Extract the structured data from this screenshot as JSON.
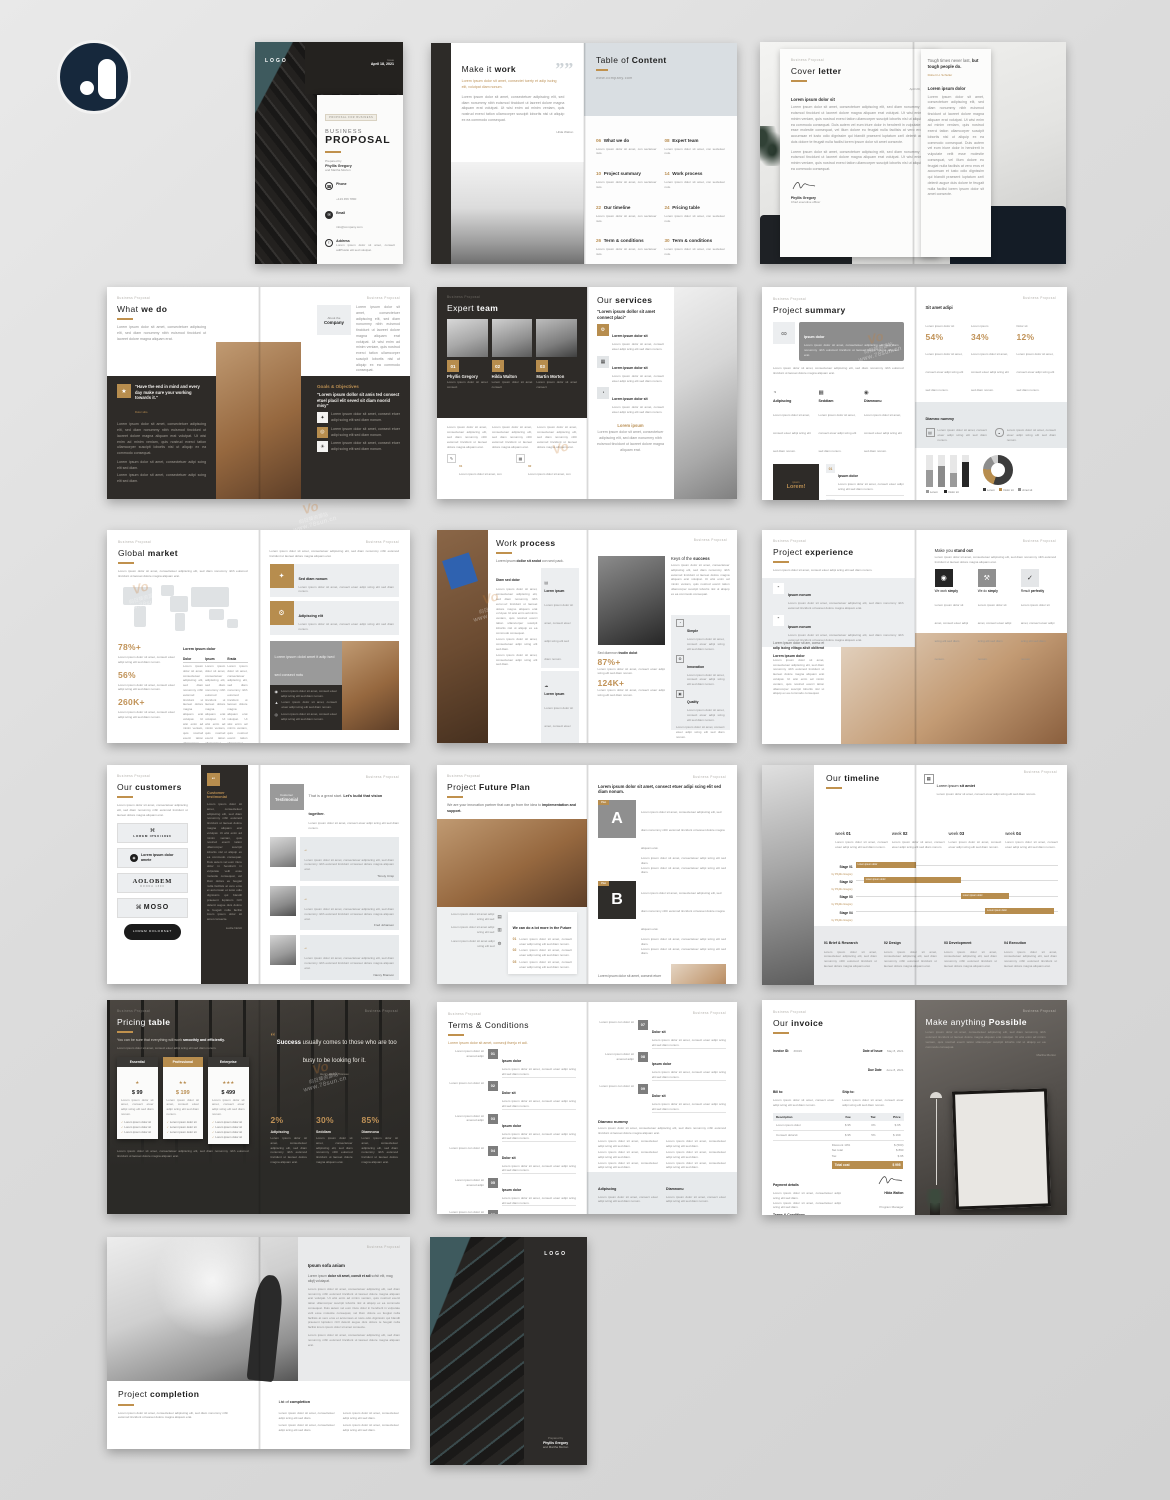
{
  "watermark": {
    "cn": "向日葵资源站",
    "url": "www.78sun.cn",
    "v": "Vo"
  },
  "page_header": "Business Proposal",
  "lorem": {
    "xs": "Lorem ipsum dolor sit amet, consect etuer adipi scing elit sed diam nonum.",
    "s": "Lorem ipsum dolor sit amet, consectetuer adipiscing elit, sed diam nonummy nibh euismod tincidunt ut laoreet dolore magna aliquam erat.",
    "m": "Lorem ipsum dolor sit amet, consectetuer adipiscing elit, sed diam nonummy nibh euismod tincidunt ut laoreet dolore magna aliquam erat volutpat. Ut wisi enim ad minim veniam, quis nostrud exerci tation ullamcorper suscipit lobortis nisl ut aliquip ex ea commodo consequat.",
    "l": "Lorem ipsum dolor sit amet, consectetuer adipiscing elit, sed diam nonummy nibh euismod tincidunt ut laoreet dolore magna aliquam erat volutpat. Ut wisi enim ad minim veniam, quis nostrud exerci tation ullamcorper suscipit lobortis nisl ut aliquip ex ea commodo consequat. Duis autem vel eum iriure dolor in hendrerit in vulputate velit esse molestie consequat, vel illum dolore eu feugiat nulla facilisis at vero eros et accumsan et iusto odio dignissim qui blandit praesent luptatum zzril delenit augue duis dolore te feugait nulla facilisi lorem ipsum dolor sit amet consecte.",
    "bullet": "Lorem ipsum dolor sit amet, consectetuer adipi scing elit sed diam."
  },
  "cover": {
    "logo": "LOGO",
    "issue_label": "Issue",
    "issue_date": "April 18, 2021",
    "tag": "PROPOSAL FOR BUSINESS",
    "title_thin": "BUSINESS",
    "title_bold": "PROPOSAL",
    "prepared_label": "Prepared by",
    "prepared_name": "Phyllis Gregory",
    "prepared_name2": "and Martha Morton",
    "contacts": [
      {
        "glyph": "☎",
        "label": "Phone",
        "value": "+123 456 7890"
      },
      {
        "glyph": "✉",
        "label": "Email",
        "value": "info@company.com"
      },
      {
        "glyph": "⚐",
        "label": "Address",
        "value": "Lorem ipsum dolor sit amet, consect adiPlustio elit sed volutpat."
      }
    ]
  },
  "intro": {
    "title_thin": "Make it ",
    "title_bold": "work",
    "quote_glyph": "””",
    "lead": "Lorem ipsum dolor sit amet, consectet tuerty et adip iscing elit, volutpat diam nonum.",
    "author": "Hilda Walton"
  },
  "toc": {
    "title_thin": "Table of ",
    "title_bold": "Content",
    "site": "www.company.com",
    "item_desc": "Lorem ipsum dolor sit amet, con sectetuer nuis.",
    "items": [
      {
        "num": "06",
        "label": "What we do"
      },
      {
        "num": "08",
        "label": "Expert team"
      },
      {
        "num": "10",
        "label": "Project summary"
      },
      {
        "num": "14",
        "label": "Work process"
      },
      {
        "num": "22",
        "label": "Our timeline"
      },
      {
        "num": "24",
        "label": "Pricing table"
      },
      {
        "num": "26",
        "label": "Term & conditions"
      },
      {
        "num": "30",
        "label": "Term & conditions"
      }
    ]
  },
  "letter": {
    "title_thin": "Cover ",
    "title_bold": "letter",
    "date": "April 20, 2021",
    "salutation": "Lorem ipsum dolor sit",
    "sign_name": "Phyllis Gregory",
    "sign_role": "Chief executive officer",
    "quote_thin": "Tough times never last, ",
    "quote_bold": "but tough people do.",
    "quote_author": "Robert H. Schuller",
    "sub": "Lorem ipsum dolor"
  },
  "what_we_do": {
    "title_thin": "What ",
    "title_bold": "we do",
    "about_thin": "About the",
    "about_bold": "Company",
    "quote": "\"Have the end in mind and every day make sure your working towards it.\"",
    "quote_author": "Dolor sitio",
    "goals_title": "Goals & Objectives",
    "goals_lead": "\"Lorem ipsum dollor sit amis ted consect etuel placil elit seved sit diam noorid misy\"",
    "goal_glyphs": [
      "✦",
      "◎",
      "☀"
    ],
    "quote_glyph": "★"
  },
  "team": {
    "title_thin": "Expert ",
    "title_bold": "team",
    "members": [
      {
        "num": "01",
        "name": "Phyllis Gregory"
      },
      {
        "num": "02",
        "name": "Hilda Walton"
      },
      {
        "num": "03",
        "name": "Martin Morton"
      }
    ],
    "member_role": "Lorem ipsum dolor sit amet consect",
    "foot": [
      {
        "num": "01",
        "glyph": "✎"
      },
      {
        "num": "02",
        "glyph": "▦"
      }
    ],
    "foot_text": "Lorem ipsum dolor sit amet, con"
  },
  "services": {
    "title_thin": "Our ",
    "title_bold": "services",
    "lead": "\"Lorem ipsum dollor sit amet connect placi\"",
    "item_title": "Lorem ipsum dolor sit",
    "glyphs": [
      "⚙",
      "▦",
      "◔"
    ],
    "footer_title": "Lorem ipsum"
  },
  "summary": {
    "title_thin": "Project ",
    "title_bold": "summary",
    "bar_glyph": "∞",
    "bar_title": "Ipsum dolor",
    "cols": [
      {
        "glyph": "◔",
        "t": "Adipiscing"
      },
      {
        "glyph": "▦",
        "t": "Seddiam"
      },
      {
        "glyph": "◉",
        "t": "Diamnonu"
      }
    ],
    "dark_tag": "ipsum",
    "dark_word": "Lorem!",
    "nums": [
      {
        "num": "01",
        "t": "Ipsum dolor"
      },
      {
        "num": "02",
        "t": "Dolor sit"
      }
    ],
    "right_head": "Sit amet adipi",
    "stats": [
      {
        "label": "Lorem ipsum dolor sit",
        "value": "54%"
      },
      {
        "label": "Lorem ipsum",
        "value": "34%"
      },
      {
        "label": "Dolor sit",
        "value": "12%"
      }
    ],
    "band_title": "Diamno nummy",
    "band_glyphs": [
      "▤",
      "◒"
    ],
    "chart_bars": [
      "52%",
      "64%",
      "44%",
      "78%"
    ],
    "bar_legend": [
      "Lorem",
      "Dolor sit"
    ],
    "donut_legend": [
      "Lorem",
      "Dolor sit",
      "Amet sit"
    ],
    "donut_values": [
      55,
      21,
      16,
      8
    ],
    "bottom_heads": [
      "Diam sed dolor",
      "Lorem ipsum dolor"
    ]
  },
  "market": {
    "title_thin": "Global ",
    "title_bold": "market",
    "stats": [
      {
        "value": "78%+"
      },
      {
        "value": "56%"
      },
      {
        "value": "260K+"
      }
    ],
    "table_title": "Lorem ipsum dolor",
    "table_cols": [
      "Dolor",
      "Ipsum",
      "Erada"
    ],
    "cell": "Lorem ipsu adipcing elit sed",
    "cards": [
      {
        "glyph": "✦",
        "t": "Sed diam nonum"
      },
      {
        "glyph": "⚙",
        "t": "Adipiscing elit"
      }
    ],
    "panel_title": "Lorem ipsum dolot amet it adip ised sed consect notu",
    "panel_glyphs": [
      "◉",
      "▲",
      "◎"
    ]
  },
  "process": {
    "title_thin": "Work ",
    "title_bold": "process",
    "lead_thin": "Lorem ipsum ",
    "lead_bold": "dollor sit andot",
    "lead_rest": " con sect pack.",
    "sub": "Diam sed dolor",
    "cards": [
      {
        "glyph": "▤"
      },
      {
        "glyph": "☁"
      },
      {
        "glyph": "✎"
      }
    ],
    "card_title": "Lorem ipsum",
    "right_thin": "Keys of the ",
    "right_bold": "success",
    "stat_lead_thin": "Sed diamnon ",
    "stat_lead_bold": "trudin dolot",
    "stats": [
      {
        "value": "87%+"
      },
      {
        "value": "124K+"
      }
    ],
    "keys": [
      {
        "glyph": "◔",
        "t": "Simple"
      },
      {
        "glyph": "⚙",
        "t": "Innovation"
      },
      {
        "glyph": "▣",
        "t": "Quality"
      }
    ]
  },
  "experience": {
    "title_thin": "Project ",
    "title_bold": "experience",
    "items": [
      {
        "glyph": "“",
        "t": "Ipsum nonum"
      },
      {
        "glyph": "“",
        "t": "Ipsum nonum"
      }
    ],
    "bottom_lead_thin": "Lorem ipsum dolor sit am, consc et ",
    "bottom_lead_bold": "adip iscing elitago alisit obliterat",
    "bottom_head": "Lorem ipsum dolor",
    "right_thin": "Make you ",
    "right_bold": "stand out",
    "boxes": [
      {
        "glyph": "◉",
        "label_thin": "We work ",
        "label_bold": "simply"
      },
      {
        "glyph": "⚒",
        "label_thin": "We do ",
        "label_bold": "simply"
      },
      {
        "glyph": "✓",
        "label_thin": "Result ",
        "label_bold": "perfectly"
      }
    ]
  },
  "customers": {
    "title_thin": "Our ",
    "title_bold": "customers",
    "logos": [
      {
        "glyph": "⌘",
        "text": "LOREM IPSU/1890"
      },
      {
        "glyph": "◉",
        "text": "Lorem ipsum dolor amete"
      },
      {
        "text": "AOLOBEM",
        "sub": "DONNA 1890"
      },
      {
        "glyph": "⌘",
        "text": "MOSO"
      },
      {
        "text": "LOREM DOLORSET"
      }
    ],
    "panel_glyph": "“",
    "panel_title": "Customer testimonial",
    "panel_author": "Lucile Nolcit",
    "tag_thin": "Customer",
    "tag_bold": "Testimonial",
    "head_thin": "That is a great start. ",
    "head_bold": "Let's build that vision together.",
    "quote_glyph": "“",
    "testimonials": [
      {
        "name": "Timoty Crisp"
      },
      {
        "name": "Fred Johansen"
      },
      {
        "name": "Nancy Branson"
      }
    ]
  },
  "future": {
    "title_thin": "Project ",
    "title_bold": "Future Plan",
    "lead_thin": "We are your innovation partner that can go from the idea to ",
    "lead_bold": "implementation and support.",
    "side_glyphs": [
      "▤",
      "▥",
      "⚙"
    ],
    "side_text": "Lorem ipsum dolor sit amet adipi scing elit sed",
    "card_head": "We can do a lot more in the Future",
    "card_items": [
      {
        "num": "01"
      },
      {
        "num": "02"
      },
      {
        "num": "03"
      }
    ],
    "plan_tag": "Plan",
    "plans": [
      {
        "letter": "A"
      },
      {
        "letter": "B"
      }
    ],
    "bottom_sub": "Diamno nummy"
  },
  "timeline": {
    "title_thin": "Our ",
    "title_bold": "timeline",
    "note_glyph": "▦",
    "note_head_thin": "Lorem ipsum ",
    "note_head_bold": "sit amiet",
    "weeks": [
      {
        "thin": "week ",
        "bold": "01"
      },
      {
        "thin": "week ",
        "bold": "02"
      },
      {
        "thin": "week ",
        "bold": "03"
      },
      {
        "thin": "week ",
        "bold": "04"
      }
    ],
    "stages": [
      "Stage 01",
      "Stage 02",
      "Stage 03",
      "Stage 04"
    ],
    "stage_sub": "by Phyllis Gregory",
    "bar_label": "Lorem ipsum dolor",
    "phases": [
      {
        "t": "01 Brief & Research"
      },
      {
        "t": "02 Design"
      },
      {
        "t": "03 Development"
      },
      {
        "t": "04 Execution"
      }
    ]
  },
  "pricing": {
    "title_thin": "Pricing ",
    "title_bold": "table",
    "lead_thin": "You can be sure that everything will work ",
    "lead_bold": "smoothly and efficiently.",
    "plans": [
      {
        "name": "Essential",
        "price": "$ 99",
        "stars": "★"
      },
      {
        "name": "Professional",
        "price": "$ 199",
        "stars": "★★"
      },
      {
        "name": "Enterprise",
        "price": "$ 499",
        "stars": "★★★"
      }
    ],
    "feature": "Lorem ipsum dolor sit",
    "quote_glyph": "“",
    "quote_bold": "Success",
    "quote_rest": " usually comes to those who are too busy to be looking for it.",
    "quote_author": "Henry David Thoreau",
    "stats": [
      {
        "value": "2%",
        "t": "Adipiscing"
      },
      {
        "value": "30%",
        "t": "Seddiam"
      },
      {
        "value": "85%",
        "t": "Diamnonu"
      }
    ]
  },
  "terms": {
    "title": "Terms & Conditions",
    "lead": "Lorem ipsum dolor sit amet, consecji fiserju et adi.",
    "label_a": "Lorem ipsum dolor sit amered adipi",
    "label_b": "Lorem ipsum con dolor sit",
    "items": [
      {
        "num": "01",
        "t": "Ipsum dolor"
      },
      {
        "num": "02",
        "t": "Dolor sit"
      },
      {
        "num": "03",
        "t": "Ipsum dolor"
      },
      {
        "num": "04",
        "t": "Dolor sit"
      },
      {
        "num": "05",
        "t": "Ipsum dolor"
      },
      {
        "num": "06",
        "t": "Dolor sit"
      },
      {
        "num": "07",
        "t": "Dolor sit"
      },
      {
        "num": "08",
        "t": "Ipsum dolor"
      },
      {
        "num": "09",
        "t": "Dolor sit"
      }
    ],
    "sub": "Diamno nummy",
    "foot": [
      {
        "t": "Adipiscing"
      },
      {
        "t": "Diamnonu"
      }
    ]
  },
  "invoice": {
    "title_thin": "Our ",
    "title_bold": "invoice",
    "id_label": "Invoice ID:",
    "id_value": "#0029",
    "issue_label": "Date of Issue",
    "issue_value": "May 8, 2021",
    "due_label": "Due Date",
    "due_value": "June 8, 2021",
    "bill_label": "Bill to:",
    "ship_label": "Ship to:",
    "cols": [
      "Description",
      "Fee",
      "Tax",
      "Price"
    ],
    "rows": [
      [
        "Lorem ipsum dolor",
        "$ 95",
        "0%",
        "$ 95"
      ],
      [
        "Consect dolorsit",
        "$ 95",
        "5%",
        "$ 199"
      ]
    ],
    "totals": [
      [
        "Discount 10%",
        "$ (500)"
      ],
      [
        "Net total",
        "$ 890"
      ],
      [
        "Tax",
        "$ 95"
      ]
    ],
    "total_label": "Total cost",
    "total_value": "$ 995",
    "payment": "Payment details",
    "tnc": "Terms & Conditions",
    "sign_name": "Hilda Walton",
    "sign_role": "Program Manager",
    "right_thin": "Make anything ",
    "right_bold": "Possible",
    "right_author": "Martha Morton"
  },
  "completion": {
    "title_thin": "Project ",
    "title_bold": "completion",
    "side_head": "Ipsum sofa aniam",
    "side_lead_thin": "Lorem ipsum ",
    "side_lead_bold": "dolor sit amet, consit et adi",
    "side_lead_rest": " sofsit elit, mag aliqfj volutapat.",
    "list_thin": "List of ",
    "list_bold": "completion"
  },
  "back": {
    "logo": "LOGO",
    "prepared": "Prepared by",
    "name": "Phyllis Gregory",
    "name2": "and Martha Morton"
  }
}
